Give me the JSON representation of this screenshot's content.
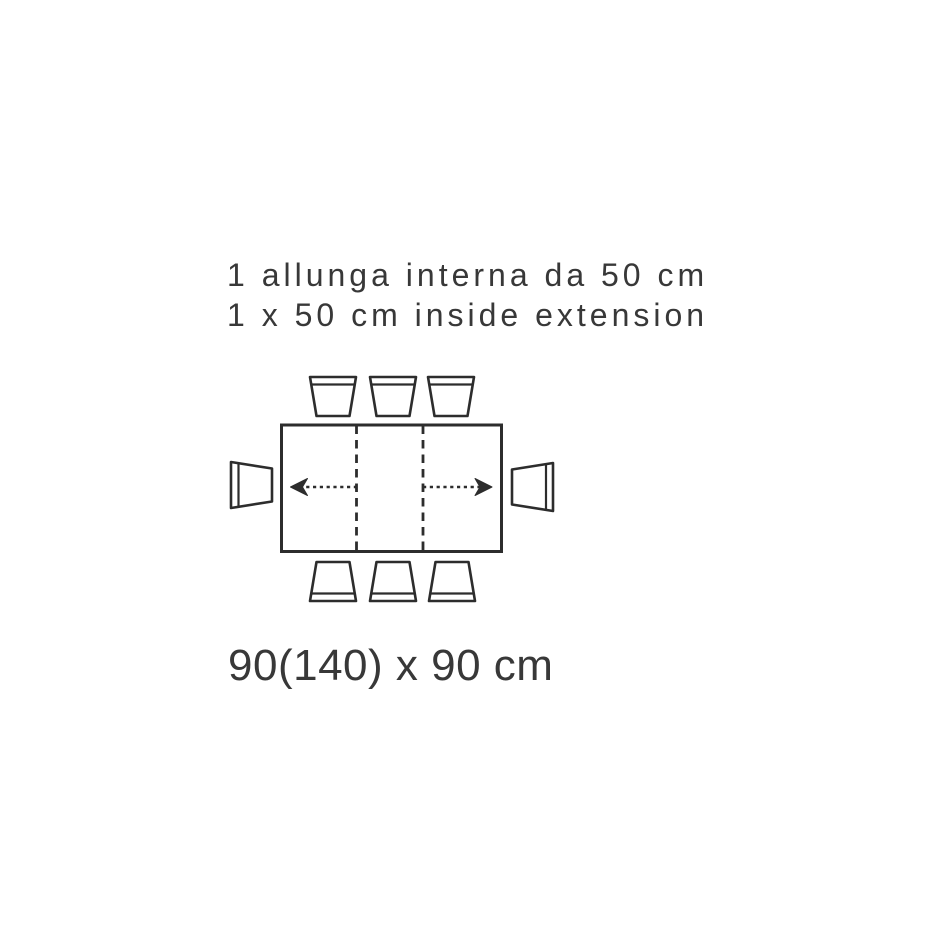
{
  "title": {
    "line1": "1 allunga interna da 50 cm",
    "line2": "1 x 50 cm inside extension"
  },
  "dimension_label": "90(140) x 90 cm",
  "diagram": {
    "type": "table-extension-plan",
    "table_shape": "rectangle",
    "closed_width_cm": 90,
    "extended_width_cm": 140,
    "depth_cm": 90,
    "extension_count": 1,
    "extension_size_cm": 50,
    "chair_count": 8,
    "chairs": {
      "top": 3,
      "bottom": 3,
      "left": 1,
      "right": 1
    },
    "fold_line_count": 2,
    "extension_arrows": [
      "left",
      "right"
    ]
  },
  "colors": {
    "background": "#ffffff",
    "line": "#2d2d2d",
    "text": "#383838"
  }
}
